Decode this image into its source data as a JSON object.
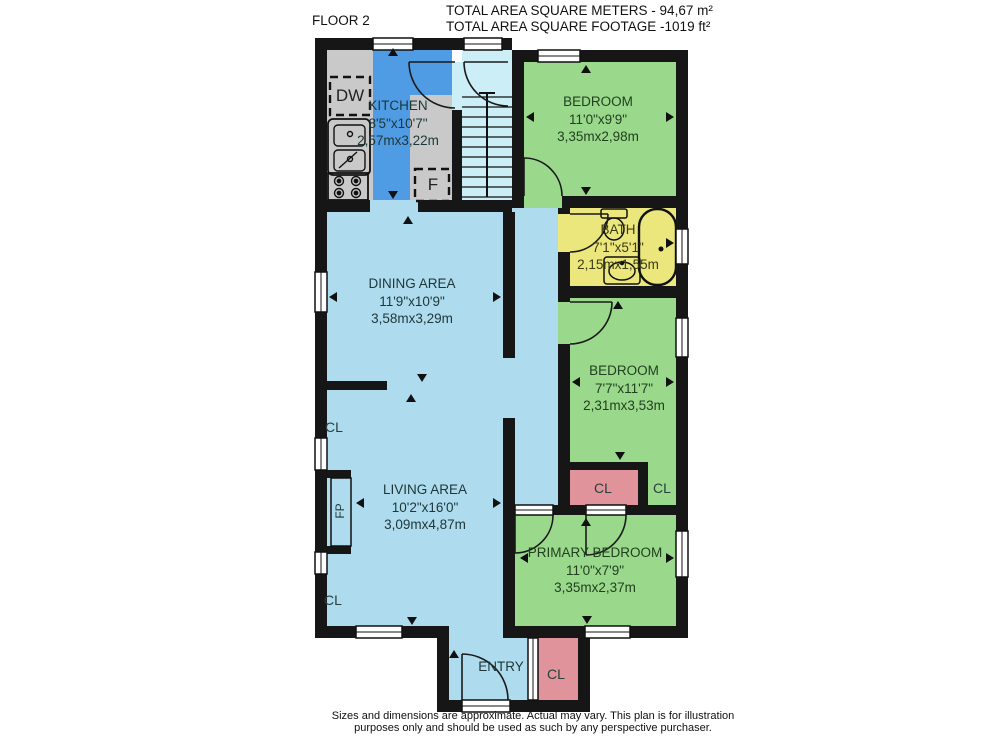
{
  "header": {
    "floor_label": "FLOOR 2",
    "area_line1": "TOTAL AREA SQUARE METERS - 94,67 m²",
    "area_line2": "TOTAL AREA SQUARE FOOTAGE -1019 ft²"
  },
  "rooms": {
    "kitchen": {
      "name": "KITCHEN",
      "dims_ft": "8'5\"x10'7\"",
      "dims_m": "2,57mx3,22m"
    },
    "bedroom_top": {
      "name": "BEDROOM",
      "dims_ft": "11'0\"x9'9\"",
      "dims_m": "3,35mx2,98m"
    },
    "bath": {
      "name": "BATH",
      "dims_ft": "7'1\"x5'1\"",
      "dims_m": "2,15mx1,55m"
    },
    "dining": {
      "name": "DINING AREA",
      "dims_ft": "11'9\"x10'9\"",
      "dims_m": "3,58mx3,29m"
    },
    "bedroom_middle": {
      "name": "BEDROOM",
      "dims_ft": "7'7\"x11'7\"",
      "dims_m": "2,31mx3,53m"
    },
    "living": {
      "name": "LIVING AREA",
      "dims_ft": "10'2\"x16'0\"",
      "dims_m": "3,09mx4,87m"
    },
    "primary_bedroom": {
      "name": "PRIMARY BEDROOM",
      "dims_ft": "11'0\"x7'9\"",
      "dims_m": "3,35mx2,37m"
    },
    "entry": {
      "name": "ENTRY"
    }
  },
  "labels": {
    "closet": "CL",
    "dishwasher": "DW",
    "fridge": "F",
    "fireplace": "FP"
  },
  "footer": {
    "line1": "Sizes and dimensions are approximate. Actual may vary. This plan is for illustration",
    "line2": "purposes only and should be used as such by any perspective purchaser."
  },
  "colors": {
    "wall": "#161616",
    "kitchen_floor_blue": "#4f9ce4",
    "living_light_blue": "#aedcee",
    "stairs_cyan": "#cceef6",
    "bedroom_green": "#9ad88c",
    "bath_yellow": "#ebe77d",
    "closet_red": "#e0939a",
    "counter_gray": "#c9c9c9"
  }
}
